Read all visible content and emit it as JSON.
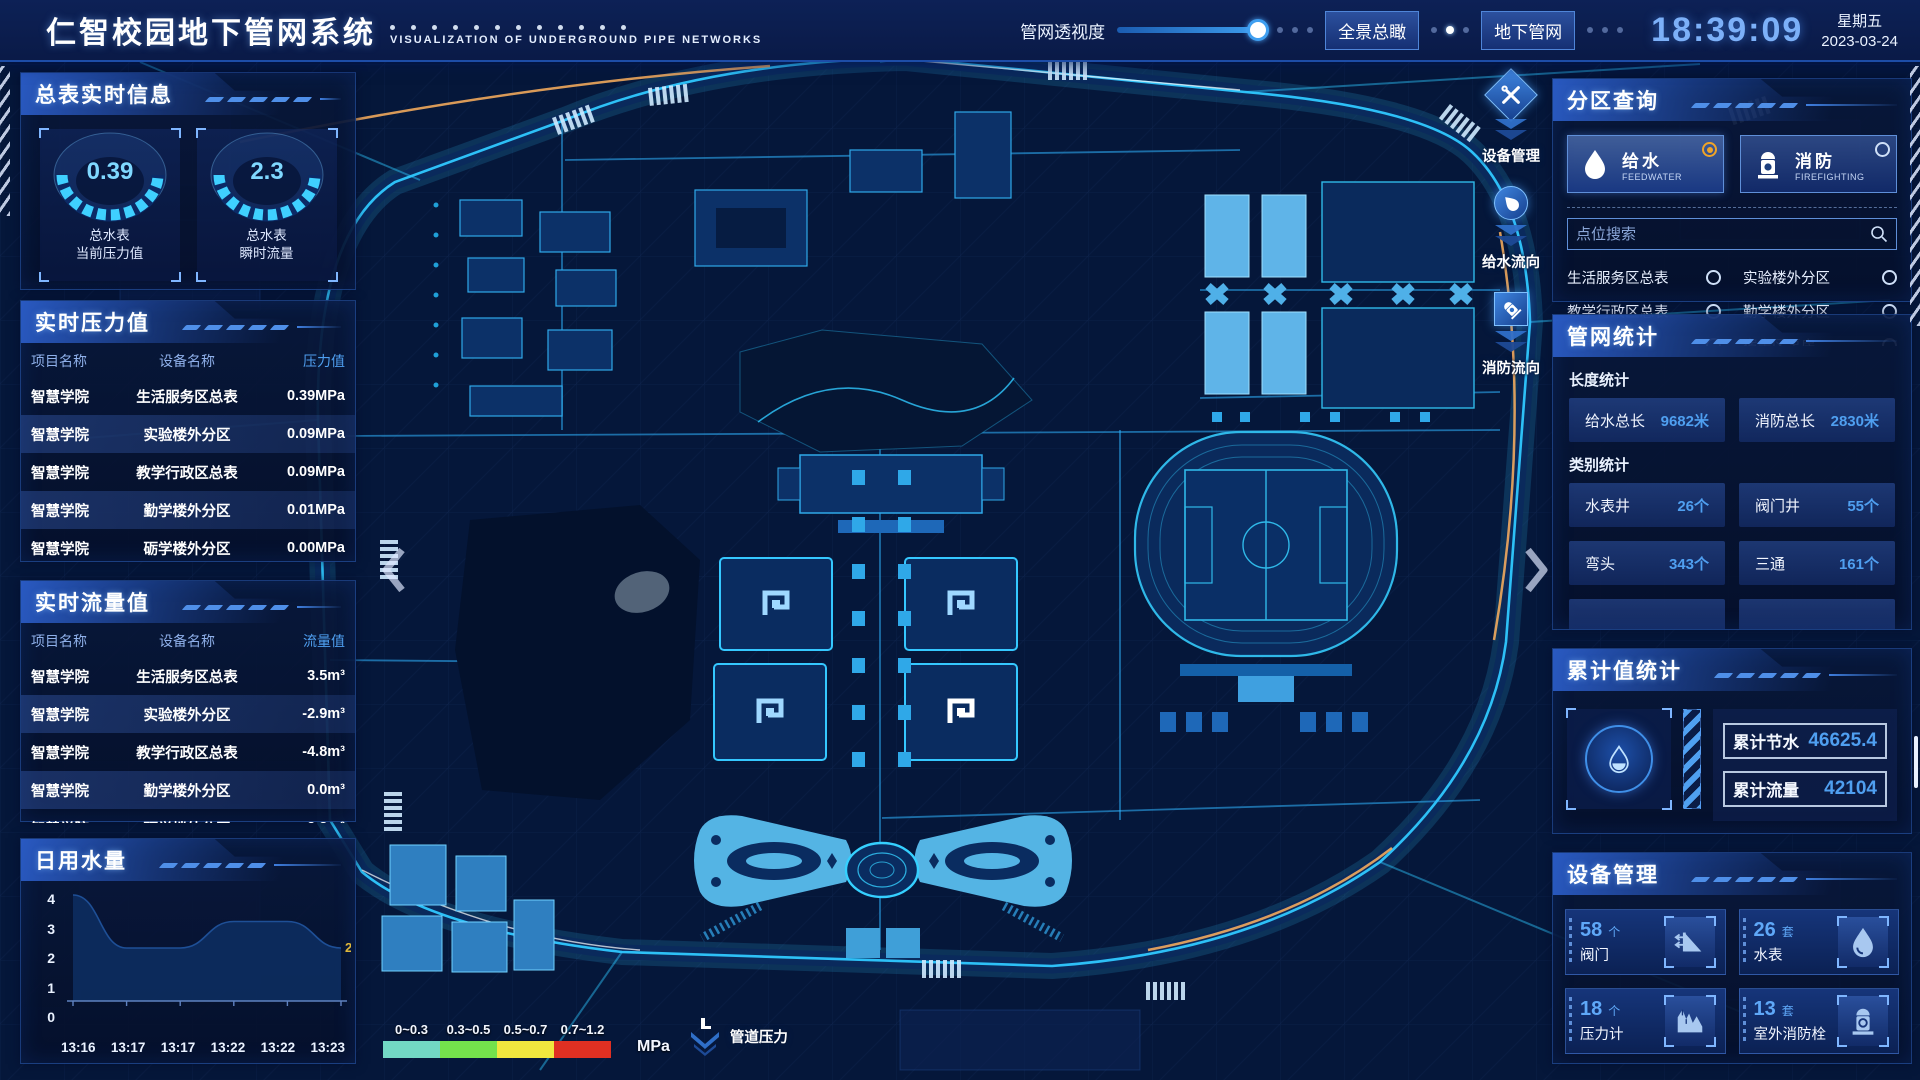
{
  "header": {
    "title": "仁智校园地下管网系统",
    "subtitle": "VISUALIZATION OF UNDERGROUND PIPE NETWORKS",
    "opacity_label": "管网透视度",
    "btn_overview": "全景总瞰",
    "btn_underground": "地下管网",
    "time": "18:39:09",
    "weekday": "星期五",
    "date": "2023-03-24"
  },
  "left": {
    "meter_info": {
      "title": "总表实时信息",
      "gauges": [
        {
          "value": "0.39",
          "label1": "总水表",
          "label2": "当前压力值"
        },
        {
          "value": "2.3",
          "label1": "总水表",
          "label2": "瞬时流量"
        }
      ]
    },
    "pressure": {
      "title": "实时压力值",
      "headers": [
        "项目名称",
        "设备名称",
        "压力值"
      ],
      "rows": [
        [
          "智慧学院",
          "生活服务区总表",
          "0.39MPa"
        ],
        [
          "智慧学院",
          "实验楼外分区",
          "0.09MPa"
        ],
        [
          "智慧学院",
          "教学行政区总表",
          "0.09MPa"
        ],
        [
          "智慧学院",
          "勤学楼外分区",
          "0.01MPa"
        ],
        [
          "智慧学院",
          "砺学楼外分区",
          "0.00MPa"
        ]
      ]
    },
    "flow": {
      "title": "实时流量值",
      "headers": [
        "项目名称",
        "设备名称",
        "流量值"
      ],
      "rows": [
        [
          "智慧学院",
          "生活服务区总表",
          "3.5m³"
        ],
        [
          "智慧学院",
          "实验楼外分区",
          "-2.9m³"
        ],
        [
          "智慧学院",
          "教学行政区总表",
          "-4.8m³"
        ],
        [
          "智慧学院",
          "勤学楼外分区",
          "0.0m³"
        ],
        [
          "智慧学院",
          "砺学楼外分区",
          "2.3m³"
        ]
      ]
    },
    "daily_water": {
      "title": "日用水量"
    }
  },
  "chart_data": {
    "type": "area",
    "title": "日用水量",
    "x": [
      "13:16",
      "13:17",
      "13:17",
      "13:22",
      "13:22",
      "13:23"
    ],
    "values": [
      4,
      2,
      2,
      3,
      3,
      2
    ],
    "ylim": [
      0,
      4
    ],
    "yticks": [
      0,
      1,
      2,
      3,
      4
    ],
    "end_label": "2",
    "end_label_color": "#e0b83a",
    "area_color": "#0d2c5e",
    "grid": false,
    "legend_position": "none"
  },
  "right": {
    "zone_query": {
      "title": "分区查询",
      "tabs": [
        {
          "label": "给水",
          "sub": "FEEDWATER",
          "selected": true,
          "icon": "water-drop-icon"
        },
        {
          "label": "消防",
          "sub": "FIREFIGHTING",
          "selected": false,
          "icon": "hydrant-icon"
        }
      ],
      "search_placeholder": "点位搜索",
      "items": [
        "生活服务区总表",
        "实验楼外分区",
        "教学行政区总表",
        "勤学楼外分区",
        "砺学楼外分区",
        "宿舍区泵房"
      ]
    },
    "pipe_stats": {
      "title": "管网统计",
      "length_label": "长度统计",
      "length_stats": [
        {
          "label": "给水总长",
          "value": "9682米"
        },
        {
          "label": "消防总长",
          "value": "2830米"
        }
      ],
      "category_label": "类别统计",
      "category_stats": [
        {
          "label": "水表井",
          "value": "26个"
        },
        {
          "label": "阀门井",
          "value": "55个"
        },
        {
          "label": "弯头",
          "value": "343个"
        },
        {
          "label": "三通",
          "value": "161个"
        }
      ]
    },
    "cumulative": {
      "title": "累计值统计",
      "icon": "water-drop-icon",
      "stats": [
        {
          "label": "累计节水",
          "value": "46625.4"
        },
        {
          "label": "累计流量",
          "value": "42104"
        }
      ]
    },
    "devices": {
      "title": "设备管理",
      "cards": [
        {
          "count": "58",
          "unit": "个",
          "label": "阀门",
          "icon": "valve-icon"
        },
        {
          "count": "26",
          "unit": "套",
          "label": "水表",
          "icon": "water-drop-icon"
        },
        {
          "count": "18",
          "unit": "个",
          "label": "压力计",
          "icon": "pressure-gauge-icon"
        },
        {
          "count": "13",
          "unit": "套",
          "label": "室外消防栓",
          "icon": "hydrant-icon"
        }
      ]
    }
  },
  "map": {
    "float_tools": [
      {
        "label": "设备管理",
        "icon": "tools-icon"
      },
      {
        "label": "给水流向",
        "icon": "water-drop-icon"
      },
      {
        "label": "消防流向",
        "icon": "hydrant-icon"
      }
    ],
    "legend": {
      "segments": [
        {
          "label": "0~0.3",
          "color": "#72d8c4"
        },
        {
          "label": "0.3~0.5",
          "color": "#74e24c"
        },
        {
          "label": "0.5~0.7",
          "color": "#f0e73e"
        },
        {
          "label": "0.7~1.2",
          "color": "#e03022"
        }
      ],
      "unit": "MPa",
      "label": "管道压力",
      "icon": "pressure-indicator-icon"
    }
  },
  "colors": {
    "accent_blue": "#3f9ff0",
    "cyan_glow": "#2fc8ff",
    "value_blue": "#4f9ff0",
    "selected_orange": "#f0a428",
    "panel_bg": "#081a42"
  }
}
